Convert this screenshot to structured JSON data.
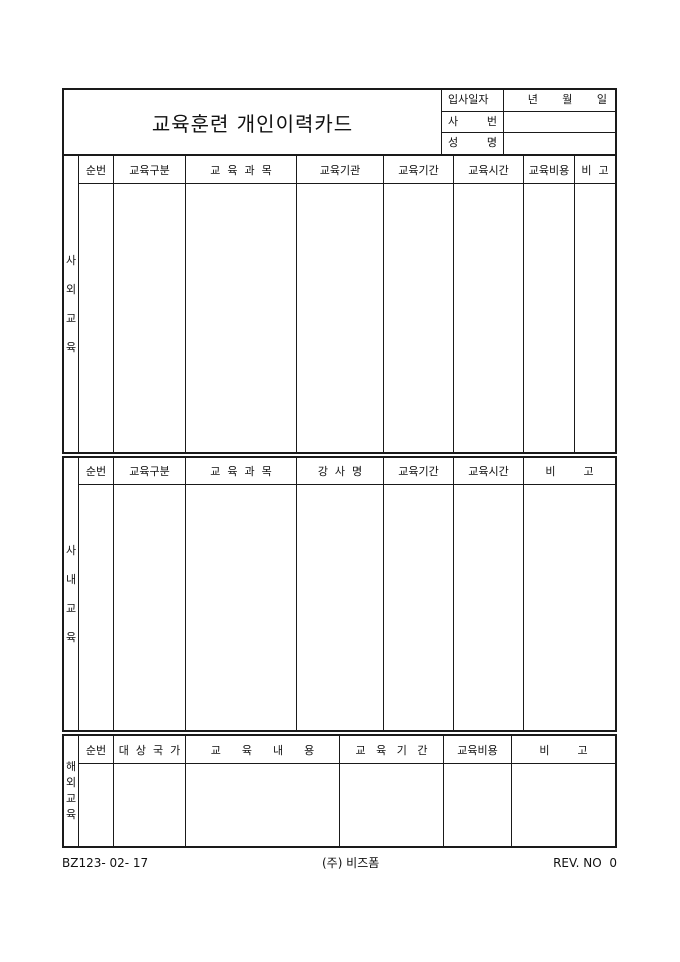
{
  "title": "교육훈련 개인이력카드",
  "info_box": {
    "rows": [
      {
        "label": "입사일자",
        "value": "년       월       일"
      },
      {
        "label": "사 번",
        "value": ""
      },
      {
        "label": "성 명",
        "value": ""
      }
    ]
  },
  "tables": [
    {
      "section_label": "사외교육",
      "headers": [
        "순번",
        "교육구분",
        "교  육  과  목",
        "교육기관",
        "교육기간",
        "교육시간",
        "교육비용",
        "비  고"
      ],
      "body_rows": []
    },
    {
      "section_label": "사내교육",
      "headers": [
        "순번",
        "교육구분",
        "교  육  과  목",
        "강  사  명",
        "교육기간",
        "교육시간",
        "비        고"
      ],
      "body_rows": []
    },
    {
      "section_label": "해외교육",
      "headers": [
        "순번",
        "대  상  국  가",
        "교      육      내      용",
        "교   육   기   간",
        "교육비용",
        "비        고"
      ],
      "body_rows": []
    }
  ],
  "footer": {
    "doc_number": "BZ123- 02- 17",
    "company": "(주) 비즈폼",
    "revision": "REV. NO  0"
  },
  "colors": {
    "border": "#1a1a1a",
    "background": "#ffffff",
    "text": "#111111"
  }
}
